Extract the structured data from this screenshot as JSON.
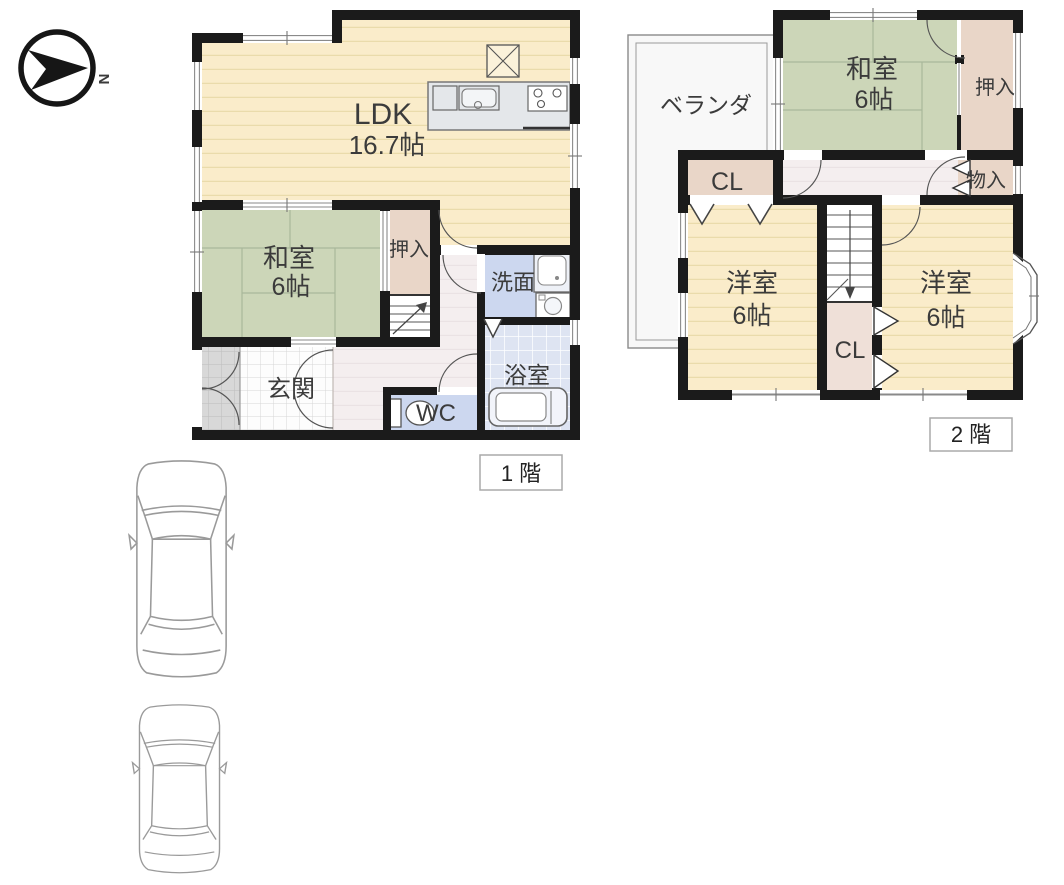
{
  "palette": {
    "wall": "#1b1b1b",
    "wood_floor": "#faecca",
    "wood_stripe": "#eadbab",
    "tatami": "#ccd6b8",
    "tatami_line": "#a9b89b",
    "closet": "#e9d6c8",
    "hallway": "#f4eeef",
    "wet_room": "#ccd7ef",
    "bath": "#dee4f2",
    "entrance_tile": "#fdfdfd",
    "porch_tile": "#d8d8d8",
    "kitchen_counter": "#e4e7ea",
    "veranda": "#f8f8f8",
    "text": "#3b3b3b"
  },
  "compass": {
    "north_label": "N"
  },
  "floor1": {
    "floor_label": "1 階",
    "ldk": {
      "name": "LDK",
      "area": "16.7帖"
    },
    "washitsu": {
      "name": "和室",
      "area": "6帖"
    },
    "oshiire": {
      "name": "押入"
    },
    "senmen": {
      "name": "洗面"
    },
    "yokushitsu": {
      "name": "浴室"
    },
    "wc": {
      "name": "WC"
    },
    "genkan": {
      "name": "玄関"
    }
  },
  "floor2": {
    "floor_label": "2 階",
    "veranda": {
      "name": "ベランダ"
    },
    "washitsu": {
      "name": "和室",
      "area": "6帖"
    },
    "oshiire": {
      "name": "押入"
    },
    "monoire": {
      "name": "物入"
    },
    "closet_hall": {
      "name": "CL"
    },
    "closet_center": {
      "name": "CL"
    },
    "yoshitsu_left": {
      "name": "洋室",
      "area": "6帖"
    },
    "yoshitsu_right": {
      "name": "洋室",
      "area": "6帖"
    }
  }
}
